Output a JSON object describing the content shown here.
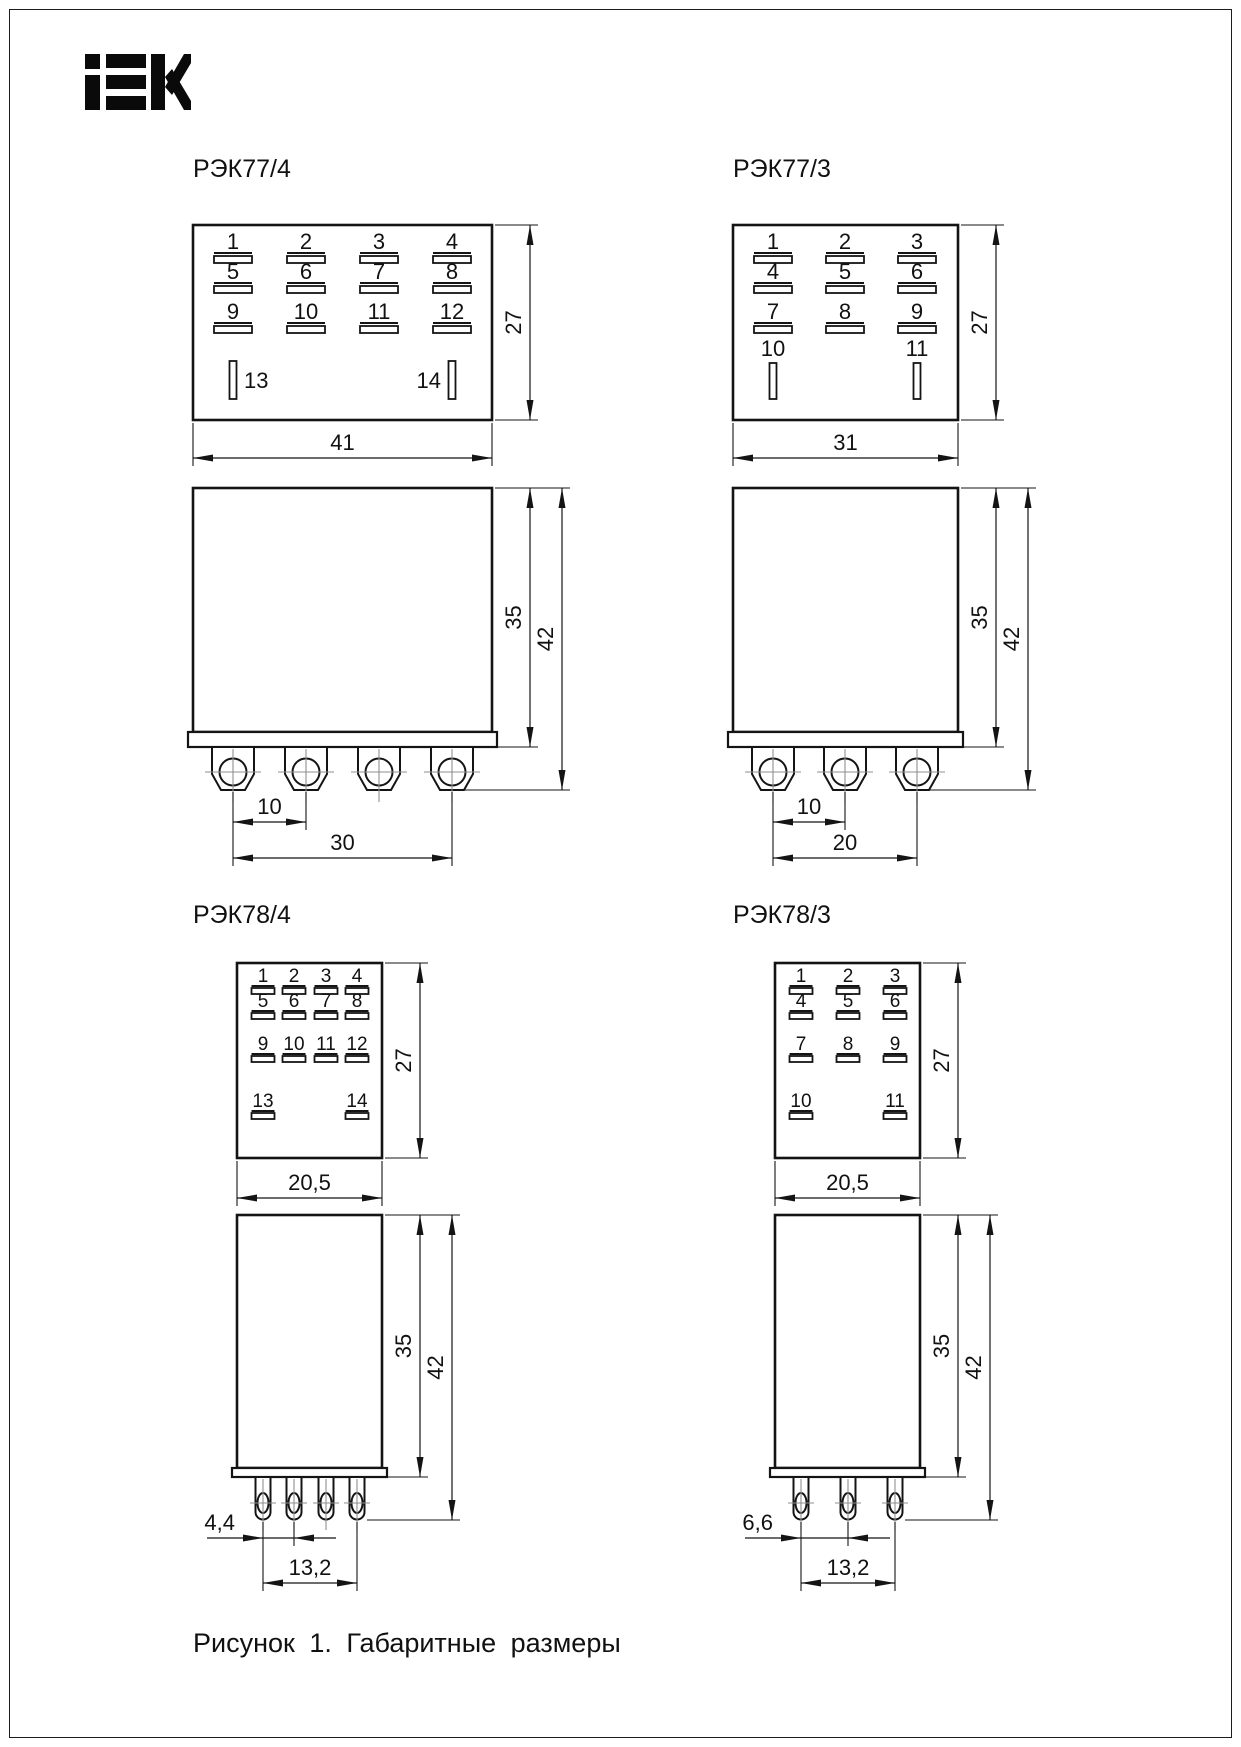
{
  "page": {
    "logo_text": "IEK",
    "caption": "Рисунок 1. Габаритные размеры"
  },
  "colors": {
    "line": "#141414",
    "centerline": "#8f8f8f",
    "background": "#ffffff"
  },
  "diagrams": [
    {
      "id": "rek77-4",
      "title": "РЭК77/4",
      "top_view": {
        "pin_rows": [
          [
            "1",
            "2",
            "3",
            "4"
          ],
          [
            "5",
            "6",
            "7",
            "8"
          ],
          [
            "9",
            "10",
            "11",
            "12"
          ]
        ],
        "bottom_pins": [
          "13",
          "14"
        ],
        "width_dim": "41",
        "height_dim": "27"
      },
      "front_view": {
        "body_height_dim": "35",
        "total_height_dim": "42",
        "pin_pitch_dim": "10",
        "pin_span_dim": "30",
        "pin_count": 4
      }
    },
    {
      "id": "rek77-3",
      "title": "РЭК77/3",
      "top_view": {
        "pin_rows": [
          [
            "1",
            "2",
            "3"
          ],
          [
            "4",
            "5",
            "6"
          ],
          [
            "7",
            "8",
            "9"
          ]
        ],
        "bottom_pins": [
          "10",
          "11"
        ],
        "width_dim": "31",
        "height_dim": "27"
      },
      "front_view": {
        "body_height_dim": "35",
        "total_height_dim": "42",
        "pin_pitch_dim": "10",
        "pin_span_dim": "20",
        "pin_count": 3
      }
    },
    {
      "id": "rek78-4",
      "title": "РЭК78/4",
      "top_view": {
        "pin_rows": [
          [
            "1",
            "2",
            "3",
            "4"
          ],
          [
            "5",
            "6",
            "7",
            "8"
          ],
          [
            "9",
            "10",
            "11",
            "12"
          ]
        ],
        "bottom_pins": [
          "13",
          "14"
        ],
        "width_dim": "20,5",
        "height_dim": "27"
      },
      "front_view": {
        "body_height_dim": "35",
        "total_height_dim": "42",
        "pin_pitch_dim": "4,4",
        "pin_span_dim": "13,2",
        "pin_count": 4
      }
    },
    {
      "id": "rek78-3",
      "title": "РЭК78/3",
      "top_view": {
        "pin_rows": [
          [
            "1",
            "2",
            "3"
          ],
          [
            "4",
            "5",
            "6"
          ],
          [
            "7",
            "8",
            "9"
          ]
        ],
        "bottom_pins": [
          "10",
          "11"
        ],
        "width_dim": "20,5",
        "height_dim": "27"
      },
      "front_view": {
        "body_height_dim": "35",
        "total_height_dim": "42",
        "pin_pitch_dim": "6,6",
        "pin_span_dim": "13,2",
        "pin_count": 3
      }
    }
  ]
}
